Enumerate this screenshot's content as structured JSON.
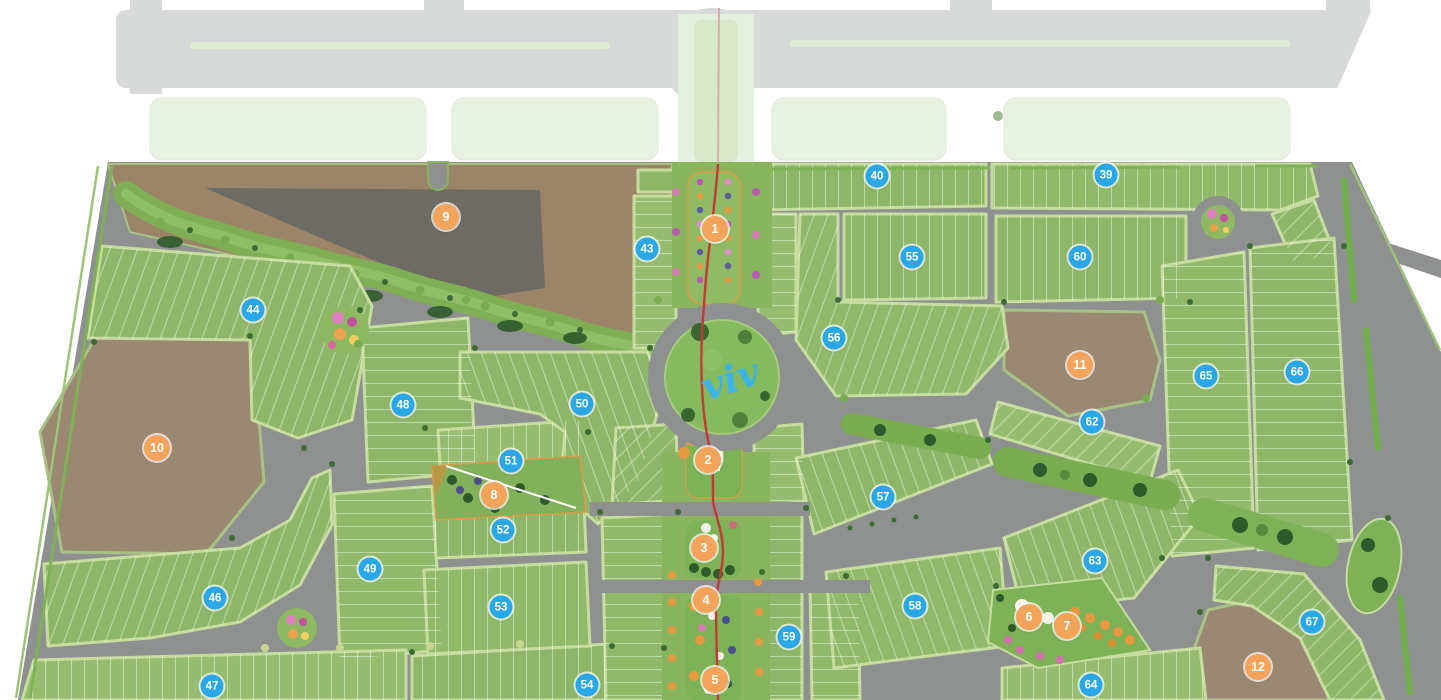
{
  "map": {
    "name": "community-master-plan",
    "logo_text": "viv",
    "colors": {
      "block_marker_blue": "#29A7E6",
      "amenity_marker_orange": "#F3A45A",
      "road_gray": "#8F9090",
      "parcel_green": "#8DB668",
      "undeveloped_brown": "#9B8872",
      "axis_path_red": "#C23A36",
      "logo_blue": "#3CB4E7"
    },
    "amenity_markers": [
      {
        "label": "1",
        "x": 715,
        "y": 229
      },
      {
        "label": "2",
        "x": 708,
        "y": 460
      },
      {
        "label": "3",
        "x": 704,
        "y": 548
      },
      {
        "label": "4",
        "x": 706,
        "y": 600
      },
      {
        "label": "5",
        "x": 715,
        "y": 680
      },
      {
        "label": "6",
        "x": 1029,
        "y": 617
      },
      {
        "label": "7",
        "x": 1067,
        "y": 626
      },
      {
        "label": "8",
        "x": 494,
        "y": 495
      },
      {
        "label": "9",
        "x": 446,
        "y": 217
      },
      {
        "label": "10",
        "x": 157,
        "y": 448
      },
      {
        "label": "11",
        "x": 1080,
        "y": 365
      },
      {
        "label": "12",
        "x": 1258,
        "y": 667
      }
    ],
    "block_markers": [
      {
        "label": "39",
        "x": 1106,
        "y": 175
      },
      {
        "label": "40",
        "x": 877,
        "y": 176
      },
      {
        "label": "43",
        "x": 647,
        "y": 249
      },
      {
        "label": "44",
        "x": 253,
        "y": 310
      },
      {
        "label": "46",
        "x": 215,
        "y": 598
      },
      {
        "label": "47",
        "x": 212,
        "y": 686
      },
      {
        "label": "48",
        "x": 403,
        "y": 405
      },
      {
        "label": "49",
        "x": 370,
        "y": 569
      },
      {
        "label": "50",
        "x": 582,
        "y": 404
      },
      {
        "label": "51",
        "x": 511,
        "y": 461
      },
      {
        "label": "52",
        "x": 503,
        "y": 530
      },
      {
        "label": "53",
        "x": 501,
        "y": 607
      },
      {
        "label": "54",
        "x": 587,
        "y": 685
      },
      {
        "label": "55",
        "x": 912,
        "y": 257
      },
      {
        "label": "56",
        "x": 834,
        "y": 338
      },
      {
        "label": "57",
        "x": 883,
        "y": 497
      },
      {
        "label": "58",
        "x": 915,
        "y": 606
      },
      {
        "label": "59",
        "x": 789,
        "y": 637
      },
      {
        "label": "60",
        "x": 1080,
        "y": 257
      },
      {
        "label": "62",
        "x": 1092,
        "y": 422
      },
      {
        "label": "63",
        "x": 1095,
        "y": 561
      },
      {
        "label": "64",
        "x": 1091,
        "y": 685
      },
      {
        "label": "65",
        "x": 1206,
        "y": 376
      },
      {
        "label": "66",
        "x": 1297,
        "y": 372
      },
      {
        "label": "67",
        "x": 1312,
        "y": 622
      }
    ]
  }
}
